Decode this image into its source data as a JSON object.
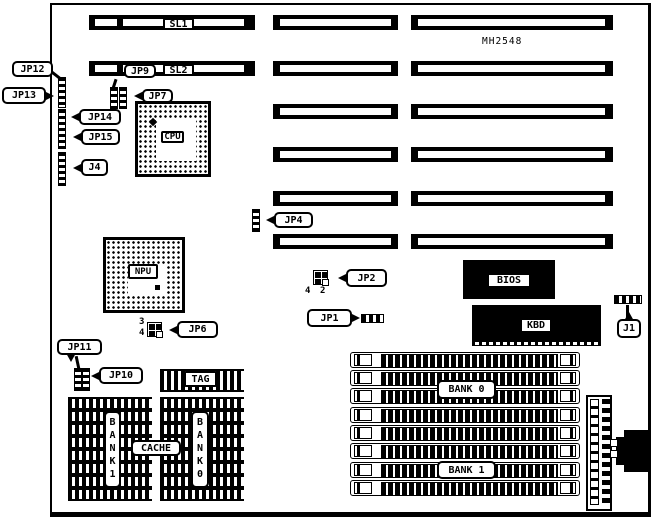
{
  "board": {
    "model": "MH2548"
  },
  "slots": {
    "sl1": "SL1",
    "sl2": "SL2"
  },
  "jumpers": {
    "jp12": "JP12",
    "jp13": "JP13",
    "jp14": "JP14",
    "jp15": "JP15",
    "j4": "J4",
    "jp9": "JP9",
    "jp7": "JP7",
    "jp4": "JP4",
    "jp2": "JP2",
    "jp1": "JP1",
    "jp6": "JP6",
    "jp11": "JP11",
    "jp10": "JP10",
    "j1": "J1"
  },
  "pins": {
    "jp2_4": "4",
    "jp2_2": "2",
    "jp6_3": "3",
    "jp6_4": "4"
  },
  "chips": {
    "cpu": "CPU",
    "npu": "NPU",
    "bios": "BIOS",
    "kbd": "KBD",
    "tag": "TAG",
    "cache": "CACHE"
  },
  "memory": {
    "simm_bank0": "BANK 0",
    "simm_bank1": "BANK 1",
    "sram_bank1": "BANK1",
    "sram_bank0": "BANK0"
  }
}
